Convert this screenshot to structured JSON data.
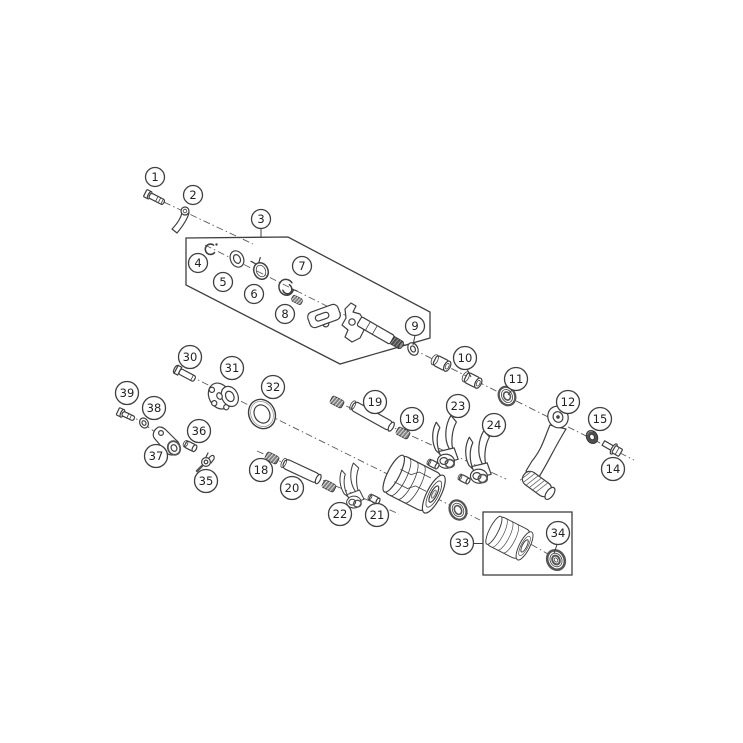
{
  "figure": {
    "type": "exploded-parts-diagram",
    "subject": "gear-shifting-mechanism",
    "background": "#ffffff",
    "line_color": "#3f3f3f",
    "dash_color": "#5a5a5a",
    "dark_fill": "#4f4f4f",
    "spring_fill": "#7f7f7f",
    "rim_color": "#555555"
  },
  "callouts": [
    {
      "label": "1",
      "x": 155,
      "y": 177
    },
    {
      "label": "2",
      "x": 193,
      "y": 195
    },
    {
      "label": "3",
      "x": 261,
      "y": 219,
      "leader": [
        261,
        228.5,
        261,
        237
      ]
    },
    {
      "label": "4",
      "x": 198,
      "y": 263
    },
    {
      "label": "5",
      "x": 223,
      "y": 282
    },
    {
      "label": "6",
      "x": 254,
      "y": 294
    },
    {
      "label": "7",
      "x": 302,
      "y": 266
    },
    {
      "label": "8",
      "x": 285,
      "y": 314
    },
    {
      "label": "9",
      "x": 415,
      "y": 326,
      "leader": [
        415,
        335.5,
        413,
        345
      ]
    },
    {
      "label": "10",
      "x": 465,
      "y": 358,
      "leader": [
        467,
        369,
        471,
        377
      ]
    },
    {
      "label": "11",
      "x": 516,
      "y": 379,
      "leader": [
        512,
        390,
        508,
        395
      ]
    },
    {
      "label": "12",
      "x": 568,
      "y": 402
    },
    {
      "label": "15",
      "x": 600,
      "y": 419
    },
    {
      "label": "14",
      "x": 613,
      "y": 469
    },
    {
      "label": "19",
      "x": 375,
      "y": 402
    },
    {
      "label": "18",
      "x": 412,
      "y": 419
    },
    {
      "label": "23",
      "x": 458,
      "y": 406
    },
    {
      "label": "24",
      "x": 494,
      "y": 425
    },
    {
      "label": "30",
      "x": 190,
      "y": 357
    },
    {
      "label": "31",
      "x": 232,
      "y": 368
    },
    {
      "label": "32",
      "x": 273,
      "y": 387
    },
    {
      "label": "39",
      "x": 127,
      "y": 393
    },
    {
      "label": "38",
      "x": 154,
      "y": 408
    },
    {
      "label": "36",
      "x": 199,
      "y": 431
    },
    {
      "label": "37",
      "x": 156,
      "y": 456
    },
    {
      "label": "35",
      "x": 206,
      "y": 481
    },
    {
      "label": "18",
      "x": 261,
      "y": 470
    },
    {
      "label": "20",
      "x": 292,
      "y": 488
    },
    {
      "label": "22",
      "x": 340,
      "y": 514
    },
    {
      "label": "21",
      "x": 377,
      "y": 515
    },
    {
      "label": "33",
      "x": 462,
      "y": 543,
      "leader": [
        474,
        543.5,
        483,
        543.5
      ]
    },
    {
      "label": "34",
      "x": 558,
      "y": 533,
      "leader": [
        557,
        544.5,
        554,
        553.5
      ]
    }
  ]
}
